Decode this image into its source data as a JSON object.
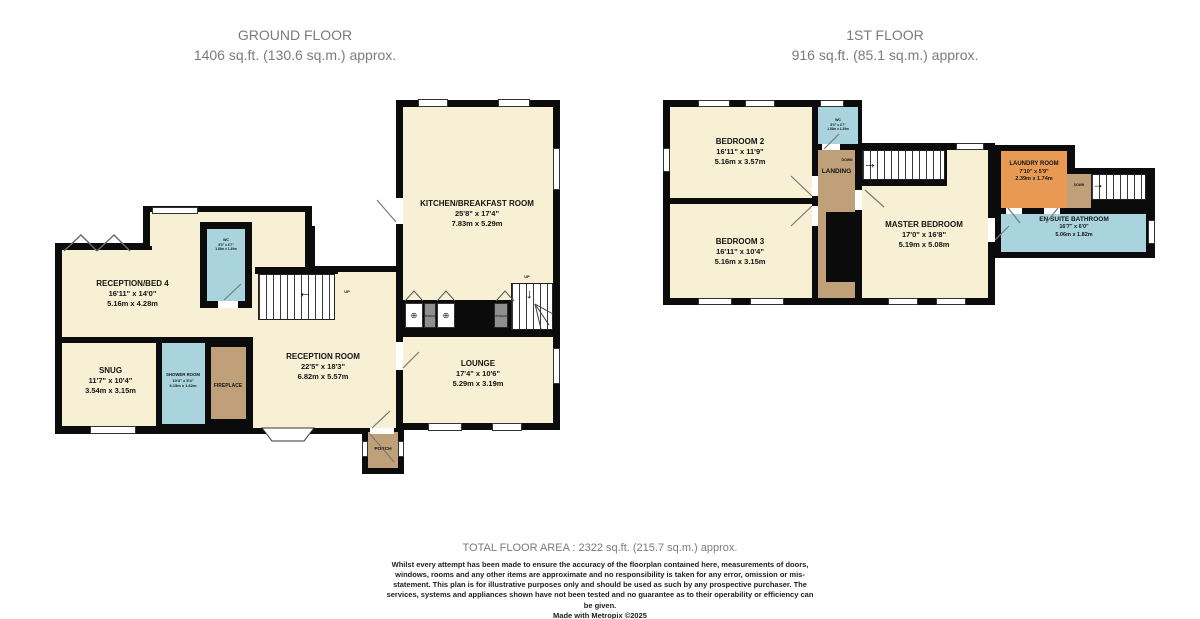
{
  "ground_floor": {
    "title": "GROUND FLOOR",
    "area": "1406 sq.ft. (130.6 sq.m.) approx.",
    "rooms": {
      "reception_bed4": {
        "name": "RECEPTION/BED 4",
        "imperial": "16'11\" x 14'0\"",
        "metric": "5.16m x 4.28m"
      },
      "kitchen": {
        "name": "KITCHEN/BREAKFAST ROOM",
        "imperial": "25'8\" x 17'4\"",
        "metric": "7.83m x 5.29m"
      },
      "wc": {
        "name": "WC",
        "imperial": "5'0\" x 4'7\"",
        "metric": "1.53m x 1.39m"
      },
      "snug": {
        "name": "SNUG",
        "imperial": "11'7\" x 10'4\"",
        "metric": "3.54m x 3.15m"
      },
      "shower_room": {
        "name": "SHOWER ROOM",
        "imperial": "10'4\" x 5'4\"",
        "metric": "3.15m x 1.62m"
      },
      "fireplace": {
        "name": "FIREPLACE"
      },
      "reception_room": {
        "name": "RECEPTION ROOM",
        "imperial": "22'5\" x 18'3\"",
        "metric": "6.82m x 5.57m"
      },
      "lounge": {
        "name": "LOUNGE",
        "imperial": "17'4\" x 10'6\"",
        "metric": "5.29m x 3.19m"
      },
      "porch": {
        "name": "PORCH"
      }
    },
    "labels": {
      "up": "UP",
      "storage": "STORAGE"
    }
  },
  "first_floor": {
    "title": "1ST FLOOR",
    "area": "916 sq.ft. (85.1 sq.m.) approx.",
    "rooms": {
      "bedroom2": {
        "name": "BEDROOM 2",
        "imperial": "16'11\" x 11'9\"",
        "metric": "5.16m x 3.57m"
      },
      "bedroom3": {
        "name": "BEDROOM 3",
        "imperial": "16'11\" x 10'4\"",
        "metric": "5.16m x 3.15m"
      },
      "master_bedroom": {
        "name": "MASTER BEDROOM",
        "imperial": "17'0\" x 16'8\"",
        "metric": "5.19m x 5.08m"
      },
      "wc": {
        "name": "WC",
        "imperial": "5'0\" x 4'7\"",
        "metric": "1.53m x 1.39m"
      },
      "landing": {
        "name": "LANDING"
      },
      "laundry_room": {
        "name": "LAUNDRY ROOM",
        "imperial": "7'10\" x 5'9\"",
        "metric": "2.39m x 1.74m"
      },
      "ensuite": {
        "name": "EN SUITE BATHROOM",
        "imperial": "16'7\" x 6'0\"",
        "metric": "5.06m x 1.82m"
      }
    },
    "labels": {
      "down": "DOWN"
    }
  },
  "icons": {
    "arrow_left": "←",
    "arrow_right": "→",
    "arrow_down": "↓",
    "appliance": "⊕"
  },
  "footer": {
    "total_area": "TOTAL FLOOR AREA : 2322 sq.ft. (215.7 sq.m.) approx.",
    "disclaimer": "Whilst every attempt has been made to ensure the accuracy of the floorplan contained here, measurements of doors, windows, rooms and any other items are approximate and no responsibility is taken for any error, omission or mis-statement. This plan is for illustrative purposes only and should be used as such by any prospective purchaser. The services, systems and appliances shown have not been tested and no guarantee as to their operability or efficiency can be given.",
    "credit": "Made with Metropix ©2025"
  },
  "colors": {
    "room_cream": "#F8F0D4",
    "room_blue": "#A9D4DD",
    "room_brown": "#C0A078",
    "room_orange": "#E89A55",
    "wall": "#0B0B0B",
    "title_gray": "#7B7B7B"
  }
}
